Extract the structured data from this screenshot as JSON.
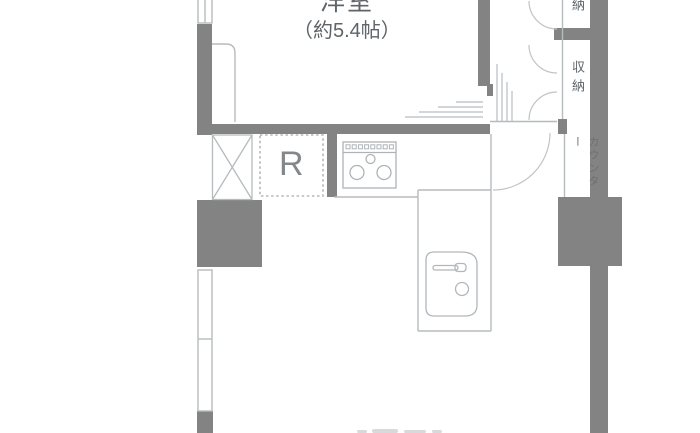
{
  "colors": {
    "wall": "#838383",
    "thin_line": "#b6bbbd",
    "text": "#5f6468",
    "refrigerator_text": "#85888b",
    "faint_fragment": "#d7dadb",
    "background": "#ffffff"
  },
  "floor_plan": {
    "rooms": {
      "western_room": {
        "label": "洋室",
        "size": "（約5.4帖）"
      }
    },
    "labels": {
      "refrigerator": "R",
      "storage_upper": "納",
      "storage_lower": "収納",
      "counter": "カウンター"
    },
    "icons": [
      "stove-icon",
      "sink-icon",
      "shaft-cross-icon",
      "door-swing-arc",
      "window",
      "sliding-door-lines",
      "wall-pillar"
    ]
  }
}
